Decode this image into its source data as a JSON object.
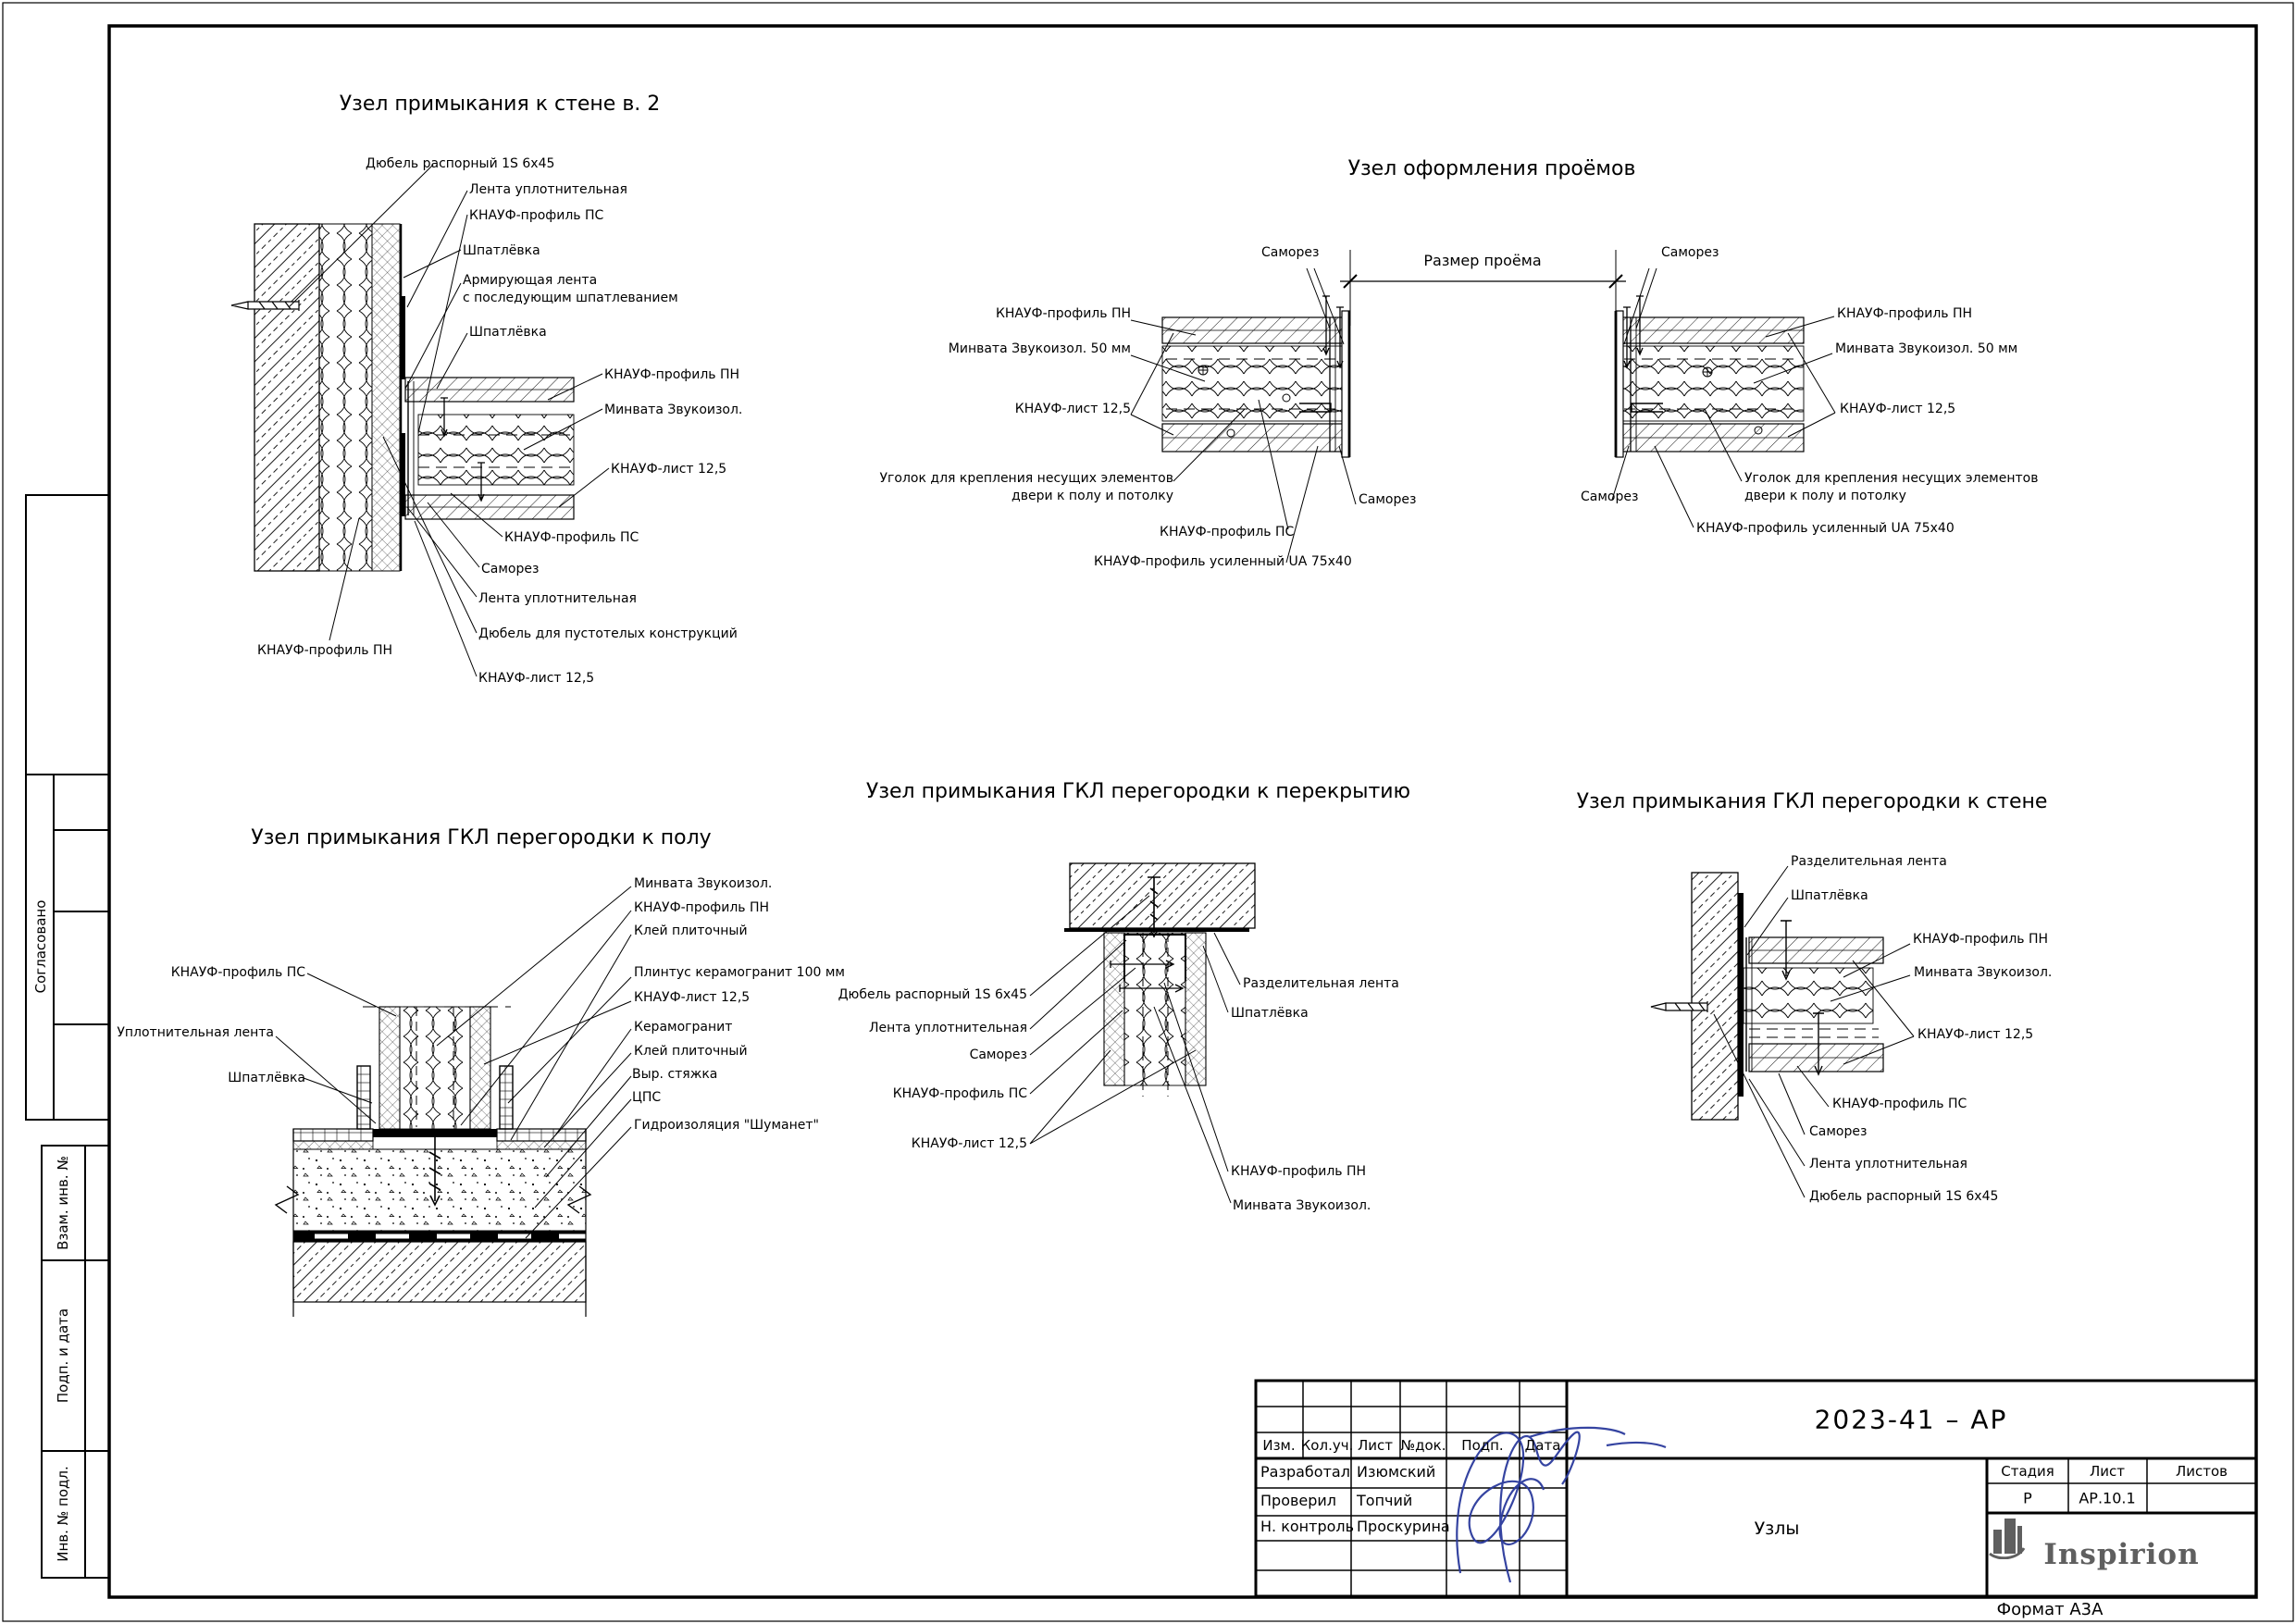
{
  "colors": {
    "signature": "#2b3a9c",
    "logo": "#5f5f5f",
    "line": "#000000"
  },
  "margin": {
    "agreed": "Согласовано",
    "replacement_inv": "Взам. инв. №",
    "sign_date": "Подп. и дата",
    "inv_original": "Инв. № подл."
  },
  "details": [
    {
      "title": "Узел примыкания к стене в. 2",
      "labels": [
        "Дюбель распорный 1S 6х45",
        "Лента уплотнительная",
        "КНАУФ-профиль ПС",
        "Шпатлёвка",
        "Армирующая лента\nс последующим шпатлеванием",
        "Шпатлёвка",
        "КНАУФ-профиль ПН",
        "Минвата Звукоизол.",
        "КНАУФ-лист 12,5",
        "КНАУФ-профиль ПС",
        "Саморез",
        "Лента уплотнительная",
        "Дюбель для пустотелых конструкций",
        "КНАУФ-лист 12,5",
        "КНАУФ-профиль ПН"
      ]
    },
    {
      "title": "Узел оформления проёмов",
      "dimension_label": "Размер проёма",
      "labels_left": [
        "Саморез",
        "КНАУФ-профиль ПН",
        "Минвата Звукоизол. 50 мм",
        "КНАУФ-лист 12,5",
        "Уголок для крепления несущих элементов\nдвери к полу и потолку",
        "Саморез",
        "КНАУФ-профиль ПС",
        "КНАУФ-профиль усиленный UA 75x40"
      ],
      "labels_right": [
        "Саморез",
        "КНАУФ-профиль ПН",
        "Минвата Звукоизол. 50 мм",
        "КНАУФ-лист 12,5",
        "Уголок для крепления несущих элементов\nдвери к полу и потолку",
        "Саморез",
        "КНАУФ-профиль усиленный UA 75x40"
      ]
    },
    {
      "title": "Узел примыкания ГКЛ перегородки к полу",
      "labels": [
        "КНАУФ-профиль ПС",
        "Уплотнительная лента",
        "Шпатлёвка",
        "Минвата Звукоизол.",
        "КНАУФ-профиль ПН",
        "Клей плиточный",
        "Плинтус керамогранит 100 мм",
        "КНАУФ-лист 12,5",
        "Керамогранит",
        "Клей плиточный",
        "Выр. стяжка",
        "ЦПС",
        "Гидроизоляция \"Шуманет\""
      ]
    },
    {
      "title": "Узел примыкания ГКЛ перегородки к перекрытию",
      "labels": [
        "Дюбель распорный 1S 6х45",
        "Лента уплотнительная",
        "Саморез",
        "КНАУФ-профиль ПС",
        "КНАУФ-лист 12,5",
        "Разделительная лента",
        "Шпатлёвка",
        "КНАУФ-профиль ПН",
        "Минвата Звукоизол."
      ]
    },
    {
      "title": "Узел примыкания ГКЛ перегородки к стене",
      "labels": [
        "Разделительная лента",
        "Шпатлёвка",
        "КНАУФ-профиль ПН",
        "Минвата Звукоизол.",
        "КНАУФ-лист 12,5",
        "КНАУФ-профиль ПС",
        "Саморез",
        "Лента уплотнительная",
        "Дюбель распорный 1S 6х45"
      ]
    }
  ],
  "title_block": {
    "code": "2023-41 – АР",
    "revision_headers": [
      "Изм.",
      "Кол.уч.",
      "Лист",
      "№док.",
      "Подп.",
      "Дата"
    ],
    "roles": [
      {
        "role": "Разработал",
        "name": "Изюмский"
      },
      {
        "role": "Проверил",
        "name": "Топчий"
      },
      {
        "role": "Н. контроль",
        "name": "Проскурина"
      }
    ],
    "stage_label": "Стадия",
    "sheet_label": "Лист",
    "sheets_label": "Листов",
    "stage": "Р",
    "sheet_number": "АР.10.1",
    "sheets_total": "",
    "doc_title": "Узлы",
    "logo_text": "Inspirion",
    "format_note": "Формат А3А"
  }
}
